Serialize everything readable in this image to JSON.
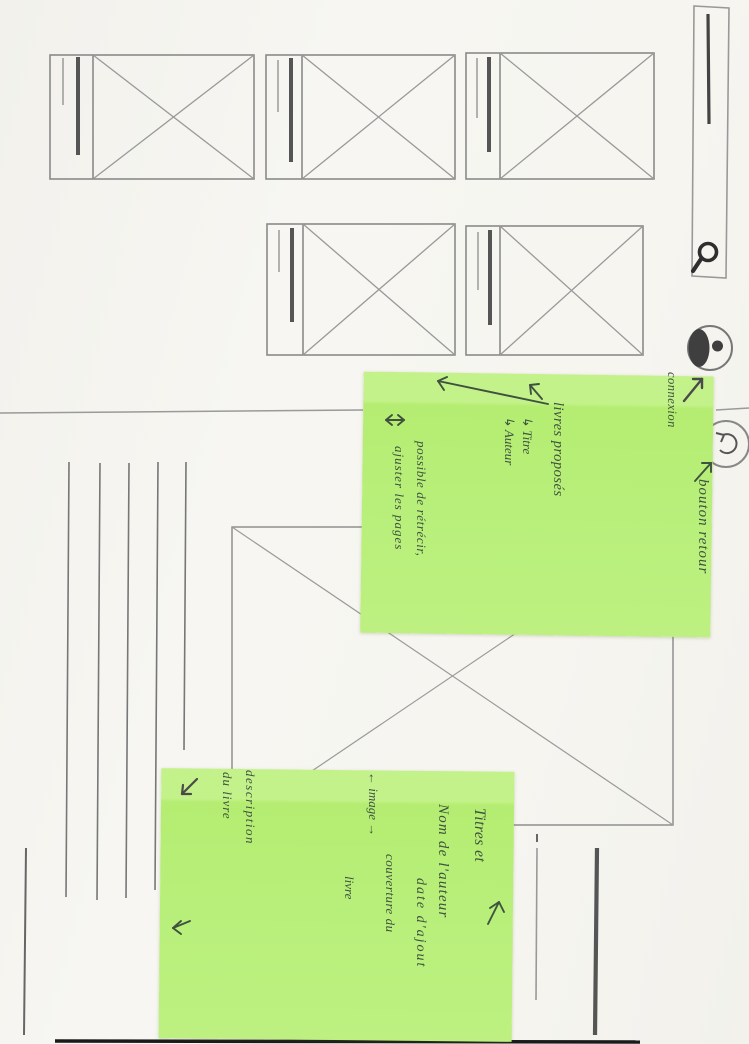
{
  "sticky_note_1": {
    "connexion": "connexion",
    "bouton_retour": "bouton retour",
    "livres_proposes": "livres proposés",
    "titre": "↳ Titre",
    "auteur": "↳ Auteur",
    "possible_1": "possible de rétrécir,",
    "possible_2": "ajuster les pages"
  },
  "sticky_note_2": {
    "titres_et": "Titres et",
    "nom_auteur": "Nom de l'auteur",
    "image_arrow": "← image →",
    "couverture": "couverture du",
    "livre": "livre",
    "date_ajout": "date d'ajout",
    "description": "description",
    "du_livre": "du livre"
  },
  "icons": {
    "search": "search-icon",
    "profile": "profile-icon",
    "back": "back-icon"
  },
  "colors": {
    "sticky_green": "#b8ef7a",
    "pen_ink": "#3e523e",
    "pencil": "#8a8a8a",
    "paper": "#f6f5f1"
  }
}
